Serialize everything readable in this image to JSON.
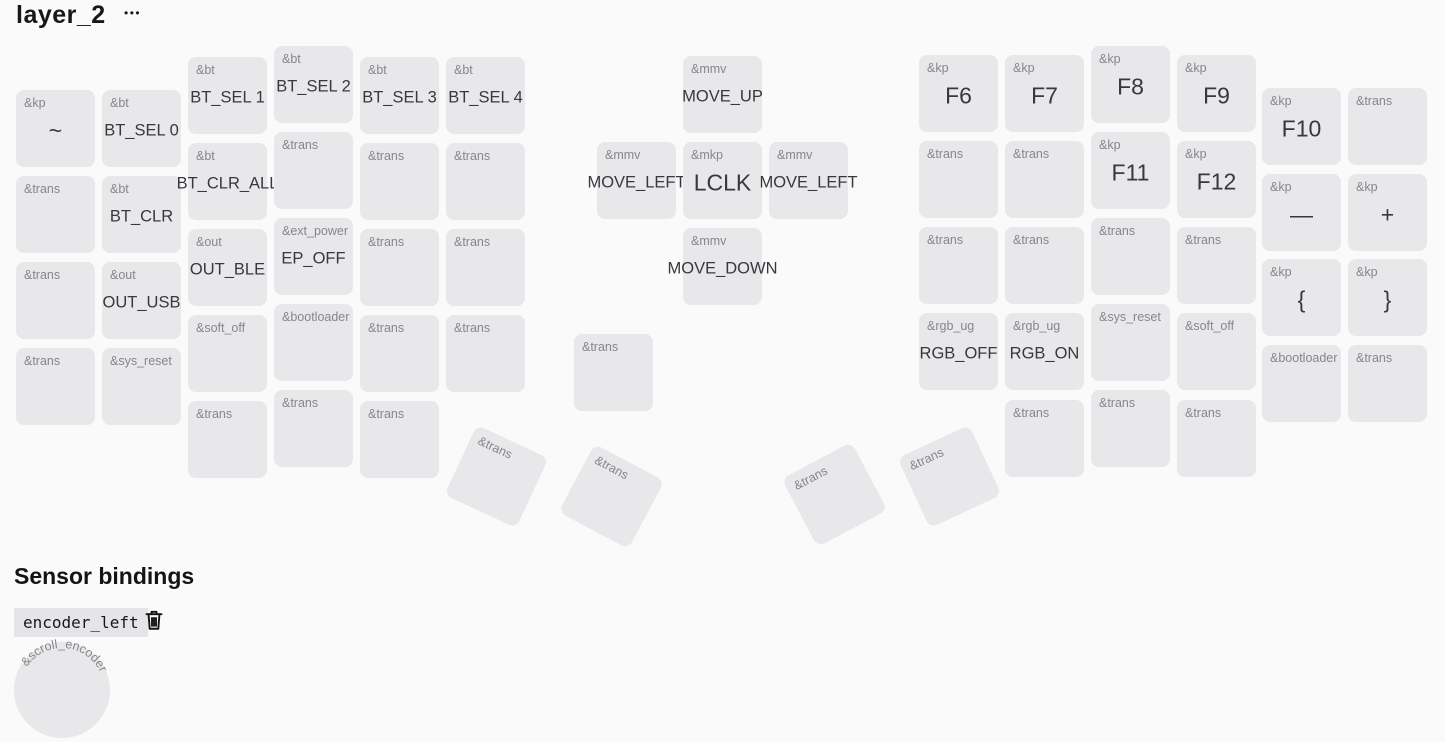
{
  "header": {
    "title": "layer_2",
    "menu_glyph": "•••"
  },
  "colors": {
    "background": "#fafafa",
    "key_fill": "#e8e8ea",
    "behavior_label": "#86868c",
    "main_label": "#38383d",
    "heading_text": "#141417",
    "chip_bg": "#e5e5e7"
  },
  "keyboard": {
    "key_width": 79,
    "key_height": 77,
    "keys": [
      {
        "x": 16,
        "y": 90,
        "b": "&kp",
        "l": "~"
      },
      {
        "x": 16,
        "y": 176,
        "b": "&trans"
      },
      {
        "x": 16,
        "y": 262,
        "b": "&trans"
      },
      {
        "x": 16,
        "y": 348,
        "b": "&trans"
      },
      {
        "x": 102,
        "y": 90,
        "b": "&bt",
        "l": "BT_SEL 0"
      },
      {
        "x": 102,
        "y": 176,
        "b": "&bt",
        "l": "BT_CLR"
      },
      {
        "x": 102,
        "y": 262,
        "b": "&out",
        "l": "OUT_USB"
      },
      {
        "x": 102,
        "y": 348,
        "b": "&sys_reset"
      },
      {
        "x": 188,
        "y": 57,
        "b": "&bt",
        "l": "BT_SEL 1"
      },
      {
        "x": 188,
        "y": 143,
        "b": "&bt",
        "l": "BT_CLR_ALL"
      },
      {
        "x": 188,
        "y": 229,
        "b": "&out",
        "l": "OUT_BLE"
      },
      {
        "x": 188,
        "y": 315,
        "b": "&soft_off"
      },
      {
        "x": 188,
        "y": 401,
        "b": "&trans"
      },
      {
        "x": 274,
        "y": 46,
        "b": "&bt",
        "l": "BT_SEL 2"
      },
      {
        "x": 274,
        "y": 132,
        "b": "&trans"
      },
      {
        "x": 274,
        "y": 218,
        "b": "&ext_power",
        "l": "EP_OFF"
      },
      {
        "x": 274,
        "y": 304,
        "b": "&bootloader"
      },
      {
        "x": 274,
        "y": 390,
        "b": "&trans"
      },
      {
        "x": 360,
        "y": 57,
        "b": "&bt",
        "l": "BT_SEL 3"
      },
      {
        "x": 360,
        "y": 143,
        "b": "&trans"
      },
      {
        "x": 360,
        "y": 229,
        "b": "&trans"
      },
      {
        "x": 360,
        "y": 315,
        "b": "&trans"
      },
      {
        "x": 360,
        "y": 401,
        "b": "&trans"
      },
      {
        "x": 446,
        "y": 57,
        "b": "&bt",
        "l": "BT_SEL 4"
      },
      {
        "x": 446,
        "y": 143,
        "b": "&trans"
      },
      {
        "x": 446,
        "y": 229,
        "b": "&trans"
      },
      {
        "x": 446,
        "y": 315,
        "b": "&trans"
      },
      {
        "x": 683,
        "y": 56,
        "b": "&mmv",
        "l": "MOVE_UP"
      },
      {
        "x": 597,
        "y": 142,
        "b": "&mmv",
        "l": "MOVE_LEFT"
      },
      {
        "x": 683,
        "y": 142,
        "b": "&mkp",
        "l": "LCLK"
      },
      {
        "x": 769,
        "y": 142,
        "b": "&mmv",
        "l": "MOVE_LEFT"
      },
      {
        "x": 683,
        "y": 228,
        "b": "&mmv",
        "l": "MOVE_DOWN"
      },
      {
        "x": 574,
        "y": 334,
        "b": "&trans"
      },
      {
        "x": 919,
        "y": 55,
        "b": "&kp",
        "l": "F6"
      },
      {
        "x": 919,
        "y": 141,
        "b": "&trans"
      },
      {
        "x": 919,
        "y": 227,
        "b": "&trans"
      },
      {
        "x": 919,
        "y": 313,
        "b": "&rgb_ug",
        "l": "RGB_OFF"
      },
      {
        "x": 1005,
        "y": 55,
        "b": "&kp",
        "l": "F7"
      },
      {
        "x": 1005,
        "y": 141,
        "b": "&trans"
      },
      {
        "x": 1005,
        "y": 227,
        "b": "&trans"
      },
      {
        "x": 1005,
        "y": 313,
        "b": "&rgb_ug",
        "l": "RGB_ON"
      },
      {
        "x": 1005,
        "y": 400,
        "b": "&trans"
      },
      {
        "x": 1091,
        "y": 46,
        "b": "&kp",
        "l": "F8"
      },
      {
        "x": 1091,
        "y": 132,
        "b": "&kp",
        "l": "F11"
      },
      {
        "x": 1091,
        "y": 218,
        "b": "&trans"
      },
      {
        "x": 1091,
        "y": 304,
        "b": "&sys_reset"
      },
      {
        "x": 1091,
        "y": 390,
        "b": "&trans"
      },
      {
        "x": 1177,
        "y": 55,
        "b": "&kp",
        "l": "F9"
      },
      {
        "x": 1177,
        "y": 141,
        "b": "&kp",
        "l": "F12"
      },
      {
        "x": 1177,
        "y": 227,
        "b": "&trans"
      },
      {
        "x": 1177,
        "y": 313,
        "b": "&soft_off"
      },
      {
        "x": 1177,
        "y": 400,
        "b": "&trans"
      },
      {
        "x": 1262,
        "y": 88,
        "b": "&kp",
        "l": "F10"
      },
      {
        "x": 1262,
        "y": 174,
        "b": "&kp",
        "l": "—"
      },
      {
        "x": 1262,
        "y": 259,
        "b": "&kp",
        "l": "{"
      },
      {
        "x": 1262,
        "y": 345,
        "b": "&bootloader"
      },
      {
        "x": 1348,
        "y": 88,
        "b": "&trans"
      },
      {
        "x": 1348,
        "y": 174,
        "b": "&kp",
        "l": "+"
      },
      {
        "x": 1348,
        "y": 259,
        "b": "&kp",
        "l": "}"
      },
      {
        "x": 1348,
        "y": 345,
        "b": "&trans"
      },
      {
        "x": 457,
        "y": 438,
        "b": "&trans",
        "rot": 25
      },
      {
        "x": 572,
        "y": 458,
        "b": "&trans",
        "rot": 28
      },
      {
        "x": 795,
        "y": 456,
        "b": "&trans",
        "rot": -28
      },
      {
        "x": 910,
        "y": 438,
        "b": "&trans",
        "rot": -25
      }
    ]
  },
  "sensors": {
    "heading": "Sensor bindings",
    "binding_chip": "encoder_left",
    "encoder": {
      "behavior": "&scroll_encoder"
    }
  }
}
